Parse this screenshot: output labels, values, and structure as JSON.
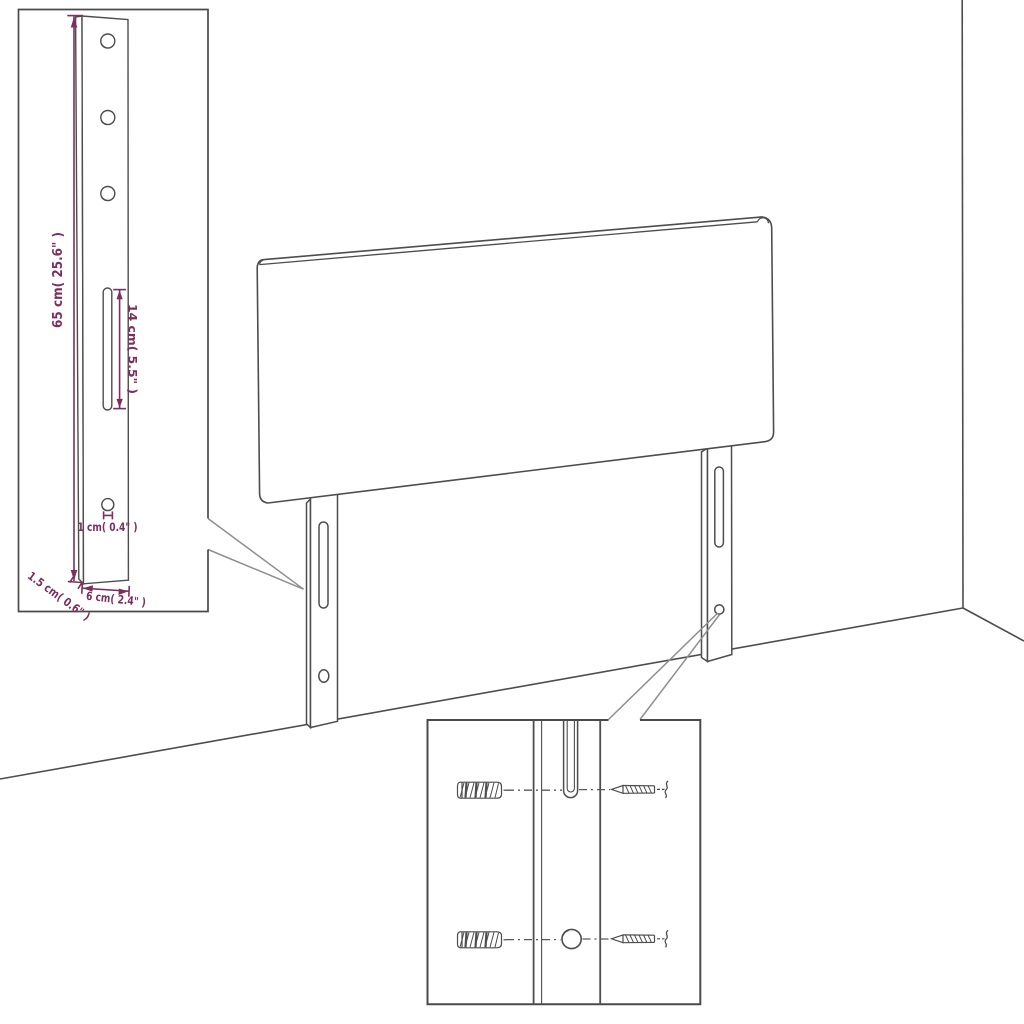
{
  "colors": {
    "background": "#ffffff",
    "line_art": "#4d4d4d",
    "inset_border": "#4a4a4a",
    "callout": "#8f8f8f",
    "leader": "#5a5a5a",
    "dimension": "#7c2e60"
  },
  "leg_inset": {
    "height_label": "65 cm( 25.6\" )",
    "slot_label": "14 cm( 5.5\" )",
    "hole_label": "1 cm( 0.4\" )",
    "thickness_label": "1.5 cm( 0.6\" )",
    "width_label": "6 cm( 2.4\" )"
  },
  "mounting_inset": {
    "icons": [
      "wall-plug-icon",
      "screw-icon",
      "mounting-slot",
      "mounting-hole"
    ]
  }
}
